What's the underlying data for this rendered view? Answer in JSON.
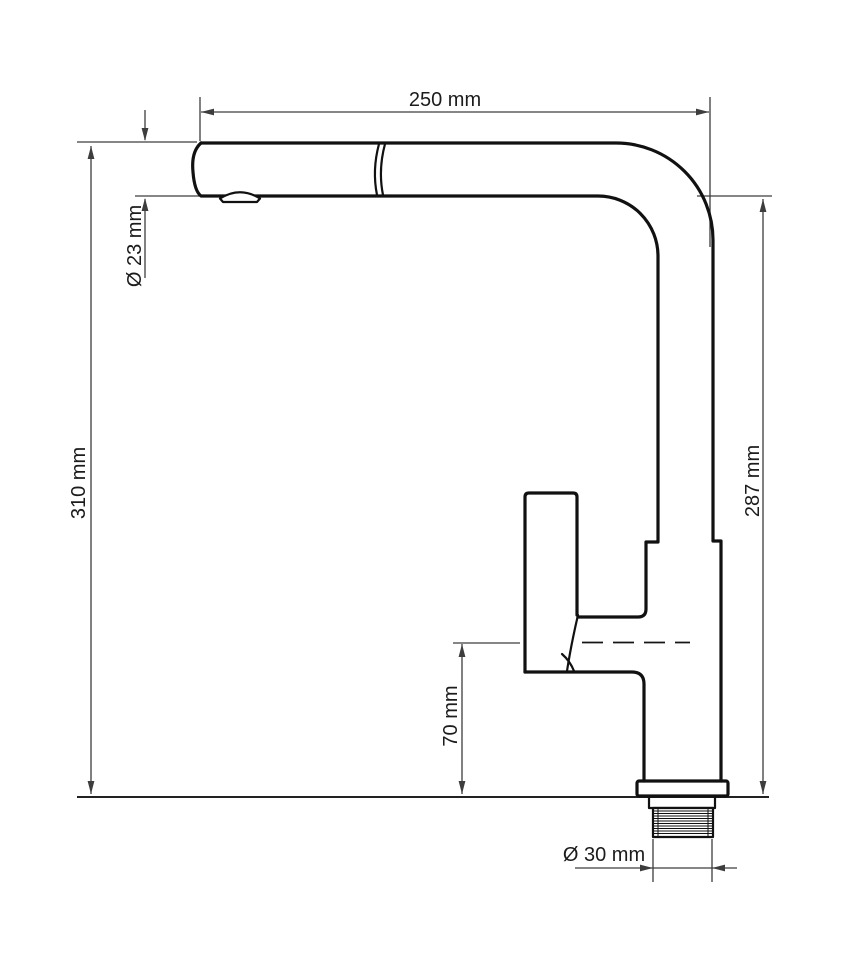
{
  "drawing": {
    "type": "technical-dimension-diagram",
    "subject": "kitchen pull-out faucet side view",
    "dimensions": {
      "spout_length": "250 mm",
      "spout_diameter": "Ø 23 mm",
      "total_height": "310 mm",
      "outlet_height": "287 mm",
      "handle_center_height": "70 mm",
      "mounting_shank_diameter": "Ø 30 mm"
    },
    "colors": {
      "background": "#ffffff",
      "outline": "#111111",
      "dimension_lines": "#3d3d3d",
      "text": "#1c1c1c"
    }
  }
}
